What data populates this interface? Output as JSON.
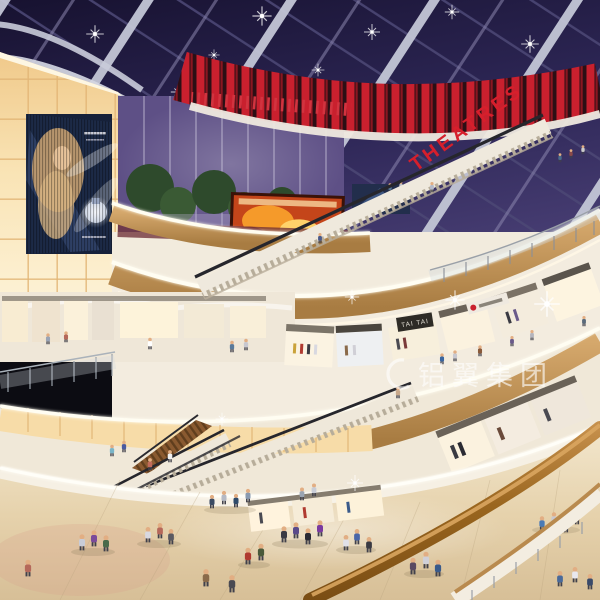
{
  "scene": {
    "type": "architectural-rendering",
    "setting": "Multi-level shopping mall atrium at evening with dark glass skylight roof",
    "signs": {
      "theatre_sign": "THEATRES",
      "store_sign_1": "TAI TAI",
      "watermark": "铝翼集团"
    },
    "features": {
      "skylight": "dark blue glass roof with diagonal white structural beams and sparkle downlights",
      "left_wall": "tall backlit warm glowing panel-grid wall",
      "ad_screen": "large LED advertising screen with perfume ad (blonde woman and bottle)",
      "cinema_band": "curved red vertical-striped cinema wall with fiery movie screen",
      "levels": "stacked curved balcony levels with wood fascias and white LED strips",
      "escalators": "multiple criss-crossing escalators between floors",
      "ground_floor": "polished beige marble floor with groups of shoppers",
      "foreground": "curved wooden handrail sweeping across lower right corner"
    },
    "colors": {
      "skylight": "#1a1535",
      "beam": "#c3c6d6",
      "cinema_red": "#c9202e",
      "panel_warm": "#f6d9a4",
      "wood": "#c1955c",
      "led": "#fffdf2",
      "floor": "#e2d0b0",
      "evening_sky": "#6a5a8e",
      "foliage": "#33512f",
      "handrail": "#96621f",
      "watermark_white": "#ffffff"
    }
  }
}
